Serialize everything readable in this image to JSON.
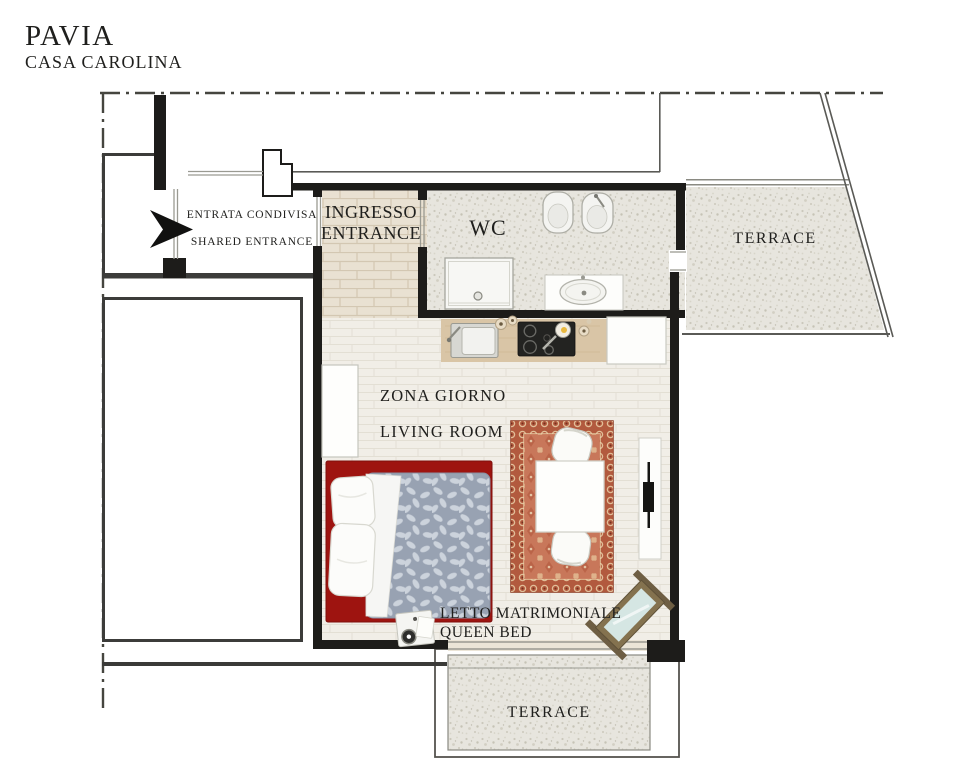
{
  "header": {
    "title": "PAVIA",
    "subtitle": "CASA CAROLINA"
  },
  "plan": {
    "shared_entrance": {
      "label_primary": "ENTRATA CONDIVISA",
      "label_secondary": "SHARED ENTRANCE"
    },
    "entrance": {
      "label_primary": "INGRESSO",
      "label_secondary": "ENTRANCE"
    },
    "wc": {
      "label": "WC"
    },
    "terrace_upper": {
      "label": "TERRACE"
    },
    "living_room": {
      "label_primary": "ZONA GIORNO",
      "label_secondary": "LIVING ROOM"
    },
    "bedroom_area": {
      "label_primary": "LETTO MATRIMONIALE",
      "label_secondary": "QUEEN BED"
    },
    "terrace_lower": {
      "label": "TERRACE"
    }
  },
  "icons": {
    "entrance_arrow": "right-arrow-icon"
  },
  "colors": {
    "wall": "#1d1c1a",
    "boundary_line": "#45453f",
    "thin_wall": "#3c3c3a",
    "terrace_floor_base": "#e7e5de",
    "entrance_floor_base": "#e9e1d2",
    "living_floor_base": "#f1eee7",
    "bed_frame": "#9e1410",
    "duvet": "#98a2b2",
    "rug_border": "#b25a3e",
    "rug_field": "#c8775a",
    "counter_wood": "#d9c5a6"
  }
}
